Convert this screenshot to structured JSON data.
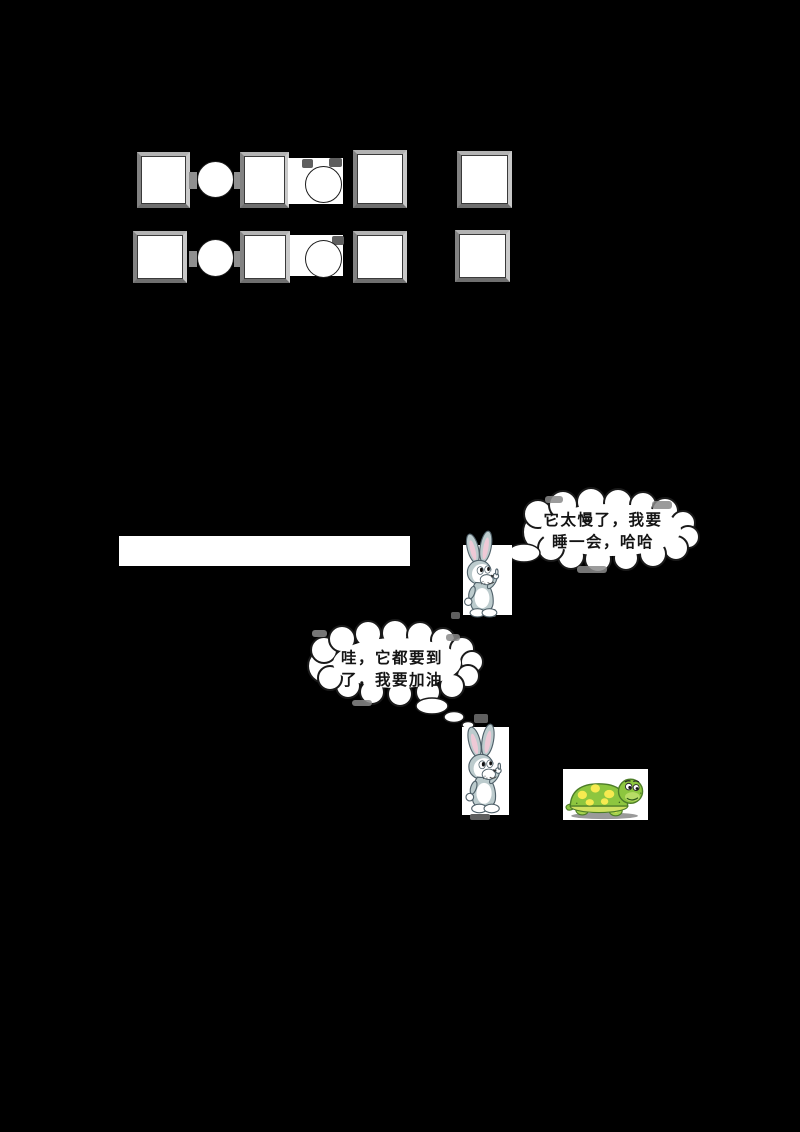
{
  "canvas": {
    "background": "#000000",
    "width": 800,
    "height": 1132
  },
  "worksheet": {
    "pattern_rows": [
      {
        "name": "row-1",
        "shapes": [
          "square",
          "circle",
          "square",
          "circle",
          "square",
          "square"
        ]
      },
      {
        "name": "row-2",
        "shapes": [
          "square",
          "circle",
          "square",
          "circle",
          "square",
          "square"
        ]
      }
    ],
    "square_fill": "#ffffff",
    "circle_fill": "#ffffff",
    "square_border_gray": "#a9a9a9"
  },
  "story": {
    "thought_bubbles": [
      {
        "speaker": "rabbit-resting",
        "line1": "它太慢了，我要",
        "line2": "睡一会，哈哈"
      },
      {
        "speaker": "rabbit-chasing",
        "line1": "哇，它都要到",
        "line2": "了，我要加油"
      }
    ],
    "characters": [
      {
        "name": "rabbit",
        "description": "cartoon baby rabbit"
      },
      {
        "name": "rabbit",
        "description": "cartoon baby rabbit"
      },
      {
        "name": "turtle",
        "description": "green cartoon turtle with yellow spots"
      }
    ]
  },
  "colors": {
    "rabbit_fur": "#bccbcd",
    "rabbit_inner_ear": "#eec9d6",
    "turtle_green": "#8dc63f",
    "turtle_spot": "#f6ea50",
    "bubble_outline": "#1a1a1a",
    "bubble_fill": "#ffffff"
  }
}
